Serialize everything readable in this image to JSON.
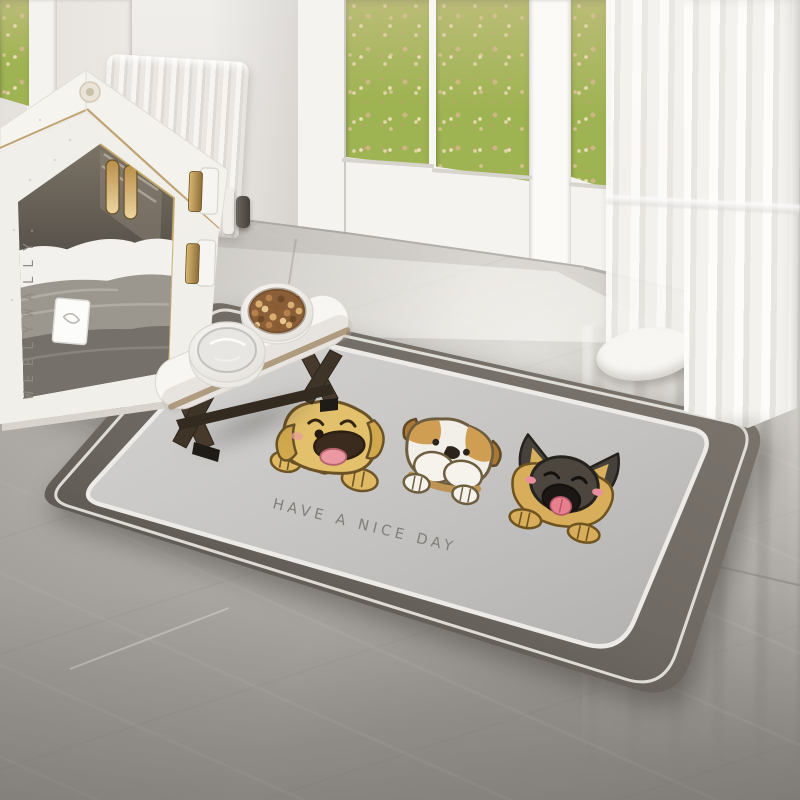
{
  "doghouse": {
    "brand_label": "WEELYWALLY.",
    "body_color": "#f1efe9",
    "trim_color": "#b6955c",
    "contents": "folded-blankets-with-tag"
  },
  "mat": {
    "message": "HAVE A NICE DAY",
    "dogs": [
      "golden-retriever",
      "english-bulldog",
      "german-shepherd"
    ],
    "colors": {
      "border": "#6e6962",
      "field": "#c6c5c3",
      "pinstripe": "#e8e6e1"
    }
  },
  "feeder": {
    "bowls": [
      "water-bowl",
      "kibble-bowl"
    ],
    "kibble_color": "#8a5f38",
    "stand_top_color": "#f8f6f2",
    "wood_color": "#3f3428"
  },
  "window": {
    "view": "autumn-grass-with-fallen-leaves",
    "grass_color": "#9eb351",
    "leaf_color": "#d8c28f",
    "frame_color": "#f5f3ef"
  },
  "palette": {
    "wall": "#eae7e3",
    "floor_light": "#dcd9d5",
    "floor_dark": "#8e8a85",
    "curtain": "#f6f5f2",
    "brass": "#b6955c"
  }
}
